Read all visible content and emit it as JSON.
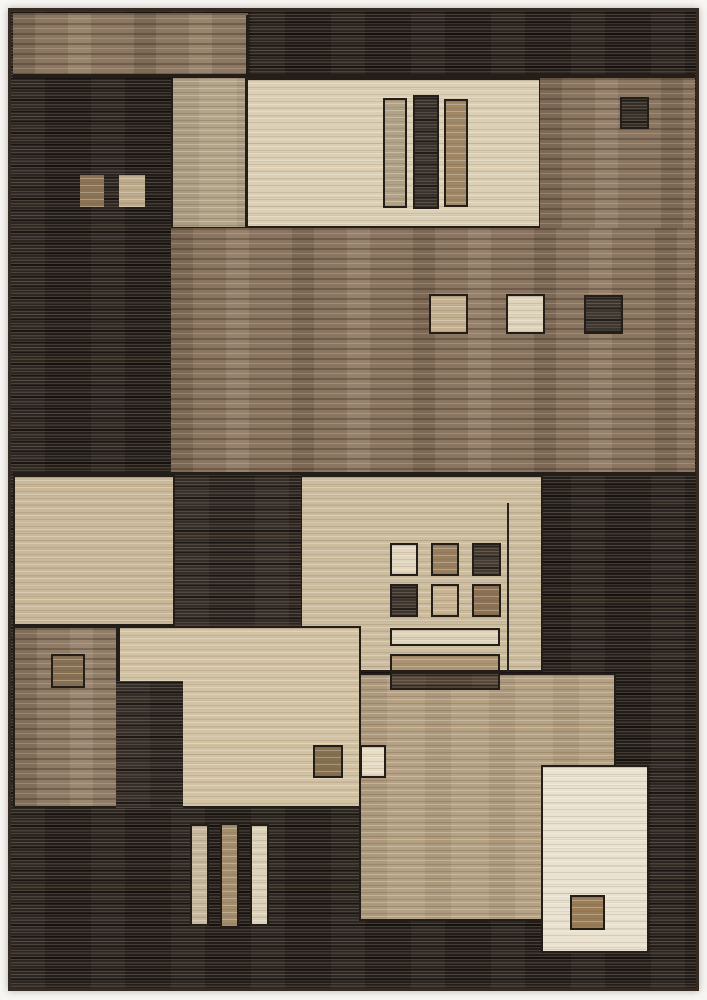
{
  "image": {
    "description": "Geometric patchwork area rug photographed on a white background, composed of overlapping rectangles and small squares in charcoal, brown, tan, beige and cream",
    "background_color": "#f7f6f3"
  },
  "rug": {
    "palette": {
      "base_dark": "#221d19",
      "outline": "#241e19",
      "binding": "#352b22",
      "brown": "#8a7560",
      "tan": "#b5a184",
      "beige": "#ccbd9f",
      "cream": "#eae2d0"
    },
    "panels": [
      {
        "name": "brown-band-top-left",
        "x": 10,
        "y": 10,
        "w": 235,
        "h": 63,
        "c": "#8c7862",
        "tex": "brown",
        "o": false
      },
      {
        "name": "tan-column-upper",
        "x": 168,
        "y": 73,
        "w": 76,
        "h": 153,
        "c": "#b3a58a",
        "tex": "tan",
        "o": true
      },
      {
        "name": "cream-panel-upper",
        "x": 243,
        "y": 75,
        "w": 295,
        "h": 150,
        "c": "#dbd0b5",
        "tex": "light",
        "o": true
      },
      {
        "name": "upper-bar-left-tan",
        "x": 380,
        "y": 95,
        "w": 24,
        "h": 110,
        "c": "#b0a287",
        "tex": "light",
        "o": true
      },
      {
        "name": "upper-bar-middle-dark",
        "x": 410,
        "y": 92,
        "w": 26,
        "h": 114,
        "c": "#2e2924",
        "tex": "dark",
        "o": true
      },
      {
        "name": "upper-bar-right-tan",
        "x": 441,
        "y": 96,
        "w": 24,
        "h": 108,
        "c": "#a08866",
        "tex": "light",
        "o": true
      },
      {
        "name": "brown-field-upper-right",
        "x": 537,
        "y": 75,
        "w": 155,
        "h": 151,
        "c": "#8a7560",
        "tex": "brown",
        "o": false
      },
      {
        "name": "brown-field-middle",
        "x": 168,
        "y": 225,
        "w": 524,
        "h": 246,
        "c": "#8a7560",
        "tex": "brown",
        "o": false
      },
      {
        "name": "boundary-line-top-band",
        "x": 10,
        "y": 71,
        "w": 682,
        "h": 4,
        "c": "#241e19",
        "tex": "flat",
        "o": false
      },
      {
        "name": "boundary-line-band-split",
        "x": 243,
        "y": 12,
        "w": 3,
        "h": 60,
        "c": "#241e19",
        "tex": "flat",
        "o": false
      },
      {
        "name": "small-square-dark-upper-right",
        "x": 617,
        "y": 94,
        "w": 29,
        "h": 32,
        "c": "#2c2620",
        "tex": "dark",
        "o": true
      },
      {
        "name": "small-square-brown-left",
        "x": 77,
        "y": 172,
        "w": 24,
        "h": 32,
        "c": "#8b7355",
        "tex": "light",
        "o": false
      },
      {
        "name": "small-square-beige-left",
        "x": 116,
        "y": 172,
        "w": 26,
        "h": 32,
        "c": "#bdab8c",
        "tex": "light",
        "o": false
      },
      {
        "name": "small-square-beige-middle",
        "x": 426,
        "y": 291,
        "w": 39,
        "h": 40,
        "c": "#c2b091",
        "tex": "light",
        "o": true
      },
      {
        "name": "small-square-cream-middle",
        "x": 503,
        "y": 291,
        "w": 39,
        "h": 40,
        "c": "#ded4bb",
        "tex": "light",
        "o": true
      },
      {
        "name": "small-square-dark-middle",
        "x": 581,
        "y": 292,
        "w": 39,
        "h": 39,
        "c": "#332d27",
        "tex": "dark",
        "o": true
      },
      {
        "name": "boundary-line-middle-bottom",
        "x": 10,
        "y": 469,
        "w": 682,
        "h": 4,
        "c": "#241e19",
        "tex": "flat",
        "o": false
      },
      {
        "name": "beige-panel-left",
        "x": 10,
        "y": 472,
        "w": 162,
        "h": 151,
        "c": "#c9b899",
        "tex": "light",
        "o": true
      },
      {
        "name": "beige-panel-center",
        "x": 297,
        "y": 472,
        "w": 243,
        "h": 197,
        "c": "#ccbd9f",
        "tex": "light",
        "o": true
      },
      {
        "name": "dark-block-center",
        "x": 172,
        "y": 472,
        "w": 126,
        "h": 151,
        "c": "#2b2420",
        "tex": "dark",
        "o": false
      },
      {
        "name": "seam-line-center-panel",
        "x": 504,
        "y": 500,
        "w": 2,
        "h": 169,
        "c": "#2a241e",
        "tex": "flat",
        "o": false
      },
      {
        "name": "grid-square-cream",
        "x": 387,
        "y": 540,
        "w": 28,
        "h": 33,
        "c": "#e2d8bf",
        "tex": "light",
        "o": true
      },
      {
        "name": "grid-square-brown",
        "x": 428,
        "y": 540,
        "w": 28,
        "h": 33,
        "c": "#97805f",
        "tex": "light",
        "o": true
      },
      {
        "name": "grid-square-dark",
        "x": 469,
        "y": 540,
        "w": 29,
        "h": 33,
        "c": "#3a322a",
        "tex": "dark",
        "o": true
      },
      {
        "name": "grid-square-dark-2",
        "x": 387,
        "y": 581,
        "w": 28,
        "h": 33,
        "c": "#352d26",
        "tex": "dark",
        "o": true
      },
      {
        "name": "grid-square-beige",
        "x": 428,
        "y": 581,
        "w": 28,
        "h": 33,
        "c": "#c7b493",
        "tex": "light",
        "o": true
      },
      {
        "name": "grid-square-brown-2",
        "x": 469,
        "y": 581,
        "w": 29,
        "h": 33,
        "c": "#8b7255",
        "tex": "light",
        "o": true
      },
      {
        "name": "stripe-bar-cream",
        "x": 387,
        "y": 625,
        "w": 110,
        "h": 18,
        "c": "#ded4bb",
        "tex": "light",
        "o": true
      },
      {
        "name": "stripe-bar-tan",
        "x": 387,
        "y": 651,
        "w": 110,
        "h": 18,
        "c": "#ab9371",
        "tex": "light",
        "o": true
      },
      {
        "name": "beige-panel-lower-center",
        "x": 115,
        "y": 623,
        "w": 243,
        "h": 182,
        "c": "#d3c3a5",
        "tex": "light",
        "o": true
      },
      {
        "name": "brown-panel-lower-left",
        "x": 10,
        "y": 623,
        "w": 105,
        "h": 182,
        "c": "#8f7c66",
        "tex": "brown",
        "o": true
      },
      {
        "name": "outlined-square-lower-left",
        "x": 48,
        "y": 651,
        "w": 34,
        "h": 34,
        "c": "#857054",
        "tex": "light",
        "o": true
      },
      {
        "name": "dark-block-lower-left",
        "x": 113,
        "y": 678,
        "w": 67,
        "h": 127,
        "c": "#2b2420",
        "tex": "dark",
        "o": false
      },
      {
        "name": "tan-panel-lower-right",
        "x": 356,
        "y": 670,
        "w": 257,
        "h": 248,
        "c": "#b5a184",
        "tex": "tan",
        "o": true
      },
      {
        "name": "stripe-bar-dark-brown",
        "x": 387,
        "y": 669,
        "w": 110,
        "h": 18,
        "c": "#4e4134",
        "tex": "dark",
        "o": true
      },
      {
        "name": "small-square-brown-pair",
        "x": 310,
        "y": 742,
        "w": 30,
        "h": 33,
        "c": "#84704f",
        "tex": "light",
        "o": true
      },
      {
        "name": "small-square-cream-pair",
        "x": 357,
        "y": 742,
        "w": 26,
        "h": 33,
        "c": "#e7ddc6",
        "tex": "light",
        "o": true
      },
      {
        "name": "cream-panel-lower-right",
        "x": 538,
        "y": 762,
        "w": 108,
        "h": 188,
        "c": "#eae2d0",
        "tex": "light",
        "o": true
      },
      {
        "name": "small-square-brown-inner",
        "x": 567,
        "y": 892,
        "w": 35,
        "h": 35,
        "c": "#997c58",
        "tex": "light",
        "o": true
      },
      {
        "name": "bottom-bar-beige",
        "x": 187,
        "y": 821,
        "w": 19,
        "h": 102,
        "c": "#c6b99f",
        "tex": "light",
        "o": true
      },
      {
        "name": "bottom-bar-tan",
        "x": 217,
        "y": 820,
        "w": 19,
        "h": 105,
        "c": "#a28e6c",
        "tex": "light",
        "o": true
      },
      {
        "name": "bottom-bar-cream",
        "x": 247,
        "y": 821,
        "w": 19,
        "h": 102,
        "c": "#dcd2ba",
        "tex": "light",
        "o": true
      }
    ]
  }
}
